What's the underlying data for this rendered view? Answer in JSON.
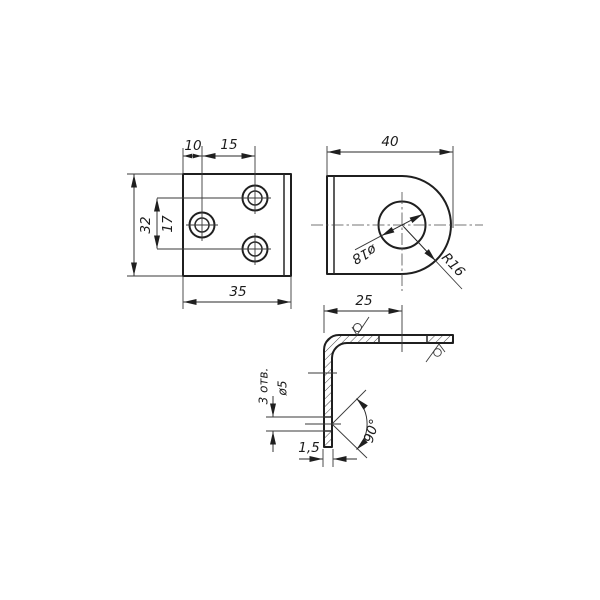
{
  "drawing": {
    "kind": "technical-drawing-angle-bracket",
    "background_color": "#ffffff",
    "line_color": "#1f1f1f",
    "views": {
      "front": {
        "label": "front view - plate with 3 holes",
        "dims": {
          "hole_offset_x": "10",
          "hole_pitch_x": "15",
          "plate_height": "32",
          "hole_pitch_y": "17",
          "plate_width": "35"
        }
      },
      "side": {
        "label": "side view - rounded lug",
        "dims": {
          "width": "40",
          "hole_diameter": "ø18",
          "corner_radius": "R16"
        }
      },
      "section": {
        "label": "section view - L profile",
        "dims": {
          "leg_to_hole": "25",
          "hole_diameter": "ø5",
          "hole_count": "3 отв.",
          "bend_angle": "90°",
          "thickness": "1,5"
        }
      }
    },
    "icons": {
      "roughness_top": "surface-roughness-icon",
      "roughness_right": "surface-roughness-icon"
    }
  }
}
